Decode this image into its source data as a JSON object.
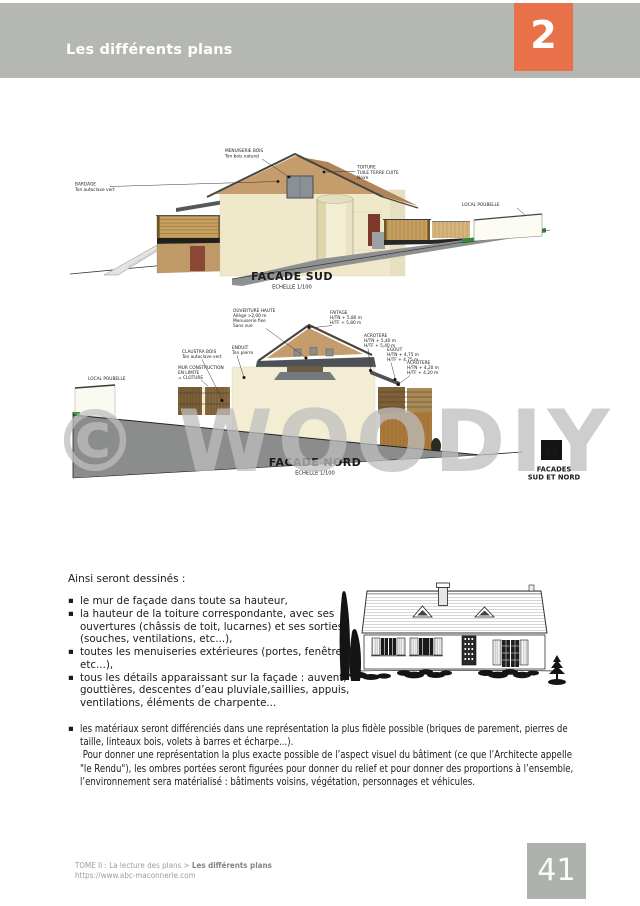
{
  "header": {
    "title": "Les différents plans",
    "chapter": "2"
  },
  "facade_sud": {
    "title": "FACADE SUD",
    "scale": "ECHELLE 1/100",
    "labels": {
      "menuiserie": [
        "MENUISERIE BOIS",
        "Ton bois naturel"
      ],
      "bardage": [
        "BARDAGE",
        "Ton autoclave vert"
      ],
      "toiture": [
        "TOITURE",
        "TUILE TERRE CUITE",
        "Noire"
      ],
      "local_poubelle": "LOCAL POUBELLE"
    }
  },
  "facade_nord": {
    "title": "FACADE NORD",
    "scale": "ECHELLE 1/100",
    "labels": {
      "ouverture": [
        "OUVERTURE HAUTE",
        "Allège >2,00 m",
        "Menuiserie fixe",
        "Sans vue"
      ],
      "faitage": [
        "FAITAGE",
        "H/TN + 5,80 m",
        "H/TF + 5,80 m"
      ],
      "acrotere_haut": [
        "ACROTERE",
        "H/TN + 5,40 m",
        "H/TF + 5,40 m"
      ],
      "egout": [
        "EGOUT",
        "H/TN + 4,75 m",
        "H/TF + 4,75 m"
      ],
      "acrotere_bas": [
        "ACROTERE",
        "H/TN + 4,20 m",
        "H/TF + 4,20 m"
      ],
      "enduit": [
        "ENDUIT",
        "Ton pierre"
      ],
      "claustra": [
        "CLAUSTRA BOIS",
        "Ton autoclave vert"
      ],
      "mur": [
        "MUR CONSTRUCTION",
        "EN LIMITE",
        "= CLOTURE"
      ],
      "local_poubelle": "LOCAL POUBELLE"
    },
    "ref_number": "09",
    "ref_caption": [
      "FACADES",
      "SUD ET NORD"
    ]
  },
  "watermark": "© WOODIY",
  "body": {
    "intro": "Ainsi seront dessinés :",
    "bullets": [
      [
        "le mur de façade dans toute sa hauteur,"
      ],
      [
        "la hauteur de la toiture correspondante, avec ses",
        "ouvertures (châssis de toit, lucarnes) et ses sorties",
        "(souches, ventilations, etc...),"
      ],
      [
        "toutes les menuiseries extérieures (portes, fenêtres,",
        "etc...),"
      ],
      [
        "tous les détails apparaissant sur la façade : auvent,",
        "gouttières, descentes d’eau pluviale,saillies, appuis,",
        "ventilations, éléments de charpente..."
      ]
    ],
    "last_bullet": [
      "les matériaux seront différenciés dans une représentation la plus fidèle possible (briques de parement, pierres de",
      "taille, linteaux bois, volets à barres et écharpe...).",
      " Pour donner une représentation la plus exacte possible de l’aspect visuel du bâtiment (ce que l’Architecte appelle",
      "\"le Rendu\"), les ombres portées seront figurées pour donner du relief et pour donner des proportions à l’ensemble,",
      "l’environnement sera matérialisé : bâtiments voisins, végétation, personnages et véhicules."
    ]
  },
  "footer": {
    "breadcrumb": "TOME II : La lecture des plans > ",
    "breadcrumb_bold": "Les différents plans",
    "url": "https://www.abc-maconnerie.com",
    "page_number": "41"
  },
  "colors": {
    "accent_orange": "#e8714a",
    "band_gray": "#b4b7b2",
    "wall_cream": "#efe8cb",
    "gable_tan": "#c59c6b",
    "dark_red": "#7d3a2b",
    "terrain_gray": "#8f9191",
    "green": "#2f8f35"
  }
}
